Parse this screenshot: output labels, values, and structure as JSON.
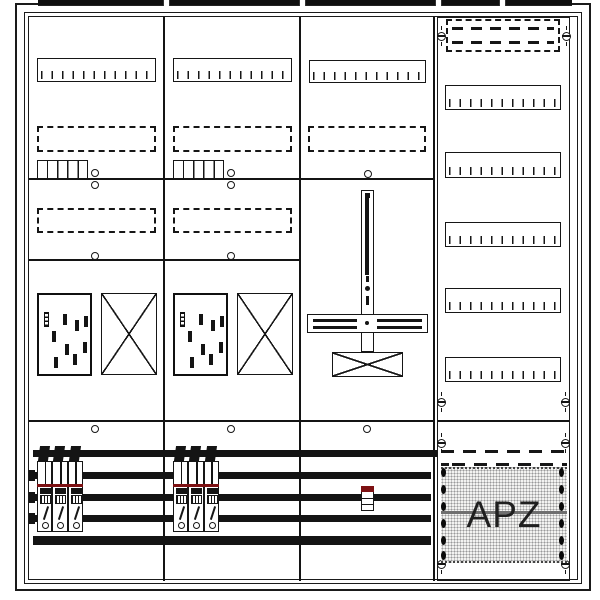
{
  "diagram": {
    "label_apz": "APZ",
    "colors": {
      "line": "#161616",
      "busbar": "#141414",
      "sls_red_stripe": "#7d1113",
      "apz_divider_gray": "#6f6f6f",
      "halftone_dot": "#9a9a9a",
      "background": "#ffffff"
    },
    "frames": {
      "outer": [
        15,
        3,
        576,
        588
      ],
      "mid": [
        24,
        12,
        558,
        572
      ],
      "inner": [
        28,
        16,
        550,
        564
      ],
      "right_column": [
        437,
        17,
        133,
        564
      ]
    },
    "top_tab": {
      "strip": [
        38,
        0,
        534,
        6
      ],
      "notches": [
        163,
        299,
        435,
        499
      ]
    },
    "dividers": [
      [
        163,
        17,
        1.5,
        564
      ],
      [
        299,
        17,
        1.5,
        564
      ],
      [
        433,
        17,
        1.5,
        564
      ]
    ],
    "lines": [
      [
        29,
        178,
        405,
        1.5
      ],
      [
        29,
        259,
        271,
        1.5
      ],
      [
        29,
        420,
        406,
        2
      ],
      [
        437,
        420,
        133,
        2
      ]
    ],
    "terminal_strips": [
      [
        37,
        58,
        119,
        24
      ],
      [
        173,
        58,
        119,
        24
      ],
      [
        309,
        60,
        117,
        23
      ],
      [
        445,
        85,
        116,
        25
      ],
      [
        445,
        152,
        116,
        26
      ],
      [
        445,
        222,
        116,
        25
      ],
      [
        445,
        288,
        116,
        25
      ],
      [
        445,
        357,
        116,
        25
      ]
    ],
    "dashed_boxes": [
      [
        37,
        126,
        119,
        26
      ],
      [
        173,
        126,
        119,
        26
      ],
      [
        308,
        126,
        118,
        26
      ],
      [
        37,
        208,
        119,
        25
      ],
      [
        173,
        208,
        119,
        25
      ],
      [
        446,
        19,
        114,
        33
      ]
    ],
    "dash_rows": [
      [
        452,
        27,
        102,
        3
      ],
      [
        452,
        41,
        102,
        3
      ]
    ],
    "wave_rows": [
      [
        441,
        450,
        126,
        2.5
      ],
      [
        441,
        463,
        126,
        2.5
      ]
    ],
    "combs": [
      [
        37,
        160,
        51,
        19
      ],
      [
        173,
        160,
        51,
        19
      ]
    ],
    "circles": [
      [
        95,
        173
      ],
      [
        95,
        185
      ],
      [
        231,
        173
      ],
      [
        231,
        185
      ],
      [
        368,
        174
      ],
      [
        95,
        256
      ],
      [
        231,
        256
      ],
      [
        95,
        429
      ],
      [
        231,
        429
      ],
      [
        367,
        429
      ]
    ],
    "screws": [
      [
        441,
        36
      ],
      [
        566,
        36
      ],
      [
        441,
        402
      ],
      [
        565,
        402
      ],
      [
        441,
        443
      ],
      [
        565,
        443
      ],
      [
        441,
        564
      ],
      [
        565,
        564
      ]
    ],
    "meters": {
      "boxes": [
        [
          37,
          293
        ],
        [
          173,
          293
        ]
      ],
      "size": [
        55,
        83
      ],
      "barcode": [
        5,
        17,
        5,
        15
      ],
      "marks": [
        [
          24,
          19
        ],
        [
          36,
          25
        ],
        [
          45,
          21
        ],
        [
          13,
          36
        ],
        [
          26,
          49
        ],
        [
          44,
          47
        ],
        [
          15,
          62
        ],
        [
          34,
          59
        ]
      ]
    },
    "xboxes": [
      [
        101,
        293,
        56,
        82
      ],
      [
        237,
        293,
        56,
        82
      ],
      [
        332,
        352,
        71,
        25
      ]
    ],
    "vbus": {
      "vbar": [
        361,
        190,
        13,
        162
      ],
      "topdot": [
        3,
        2,
        5,
        5
      ],
      "mainline": [
        3,
        6,
        4,
        78
      ],
      "dash1": [
        3.5,
        85,
        3,
        6
      ],
      "middot": [
        3,
        95,
        5,
        5
      ],
      "dash2": [
        3.5,
        105,
        3,
        9
      ],
      "hbar": [
        307,
        314,
        121,
        19
      ],
      "hlines": [
        [
          5,
          3.5,
          44,
          3.5
        ],
        [
          5,
          10.5,
          44,
          3.5
        ],
        [
          69,
          3.5,
          45,
          3.5
        ],
        [
          69,
          10.5,
          45,
          3.5
        ]
      ],
      "hdot": [
        56.5,
        6,
        4,
        4
      ]
    },
    "busbars": [
      [
        33,
        450,
        404,
        7
      ],
      [
        33,
        472,
        398,
        7
      ],
      [
        33,
        494,
        398,
        7
      ],
      [
        33,
        515,
        398,
        7
      ],
      [
        33,
        536,
        398,
        9
      ]
    ],
    "bar_nubs": [
      [
        29,
        470,
        6,
        11
      ],
      [
        29,
        492,
        6,
        11
      ],
      [
        29,
        513,
        6,
        11
      ]
    ],
    "breaker_groups": {
      "origins": [
        [
          37,
          446
        ],
        [
          173,
          446
        ]
      ],
      "units": 3,
      "unit_w": 15.33,
      "red_y": 484
    },
    "n_device": [
      361,
      486,
      13,
      25
    ],
    "apz": {
      "panel": [
        441,
        467,
        126,
        96
      ],
      "grayline": [
        441,
        511,
        126,
        3
      ],
      "diamond_x": [
        443.5,
        561.5
      ],
      "diamond_y": [
        472,
        489,
        506,
        523,
        540,
        555
      ]
    }
  }
}
